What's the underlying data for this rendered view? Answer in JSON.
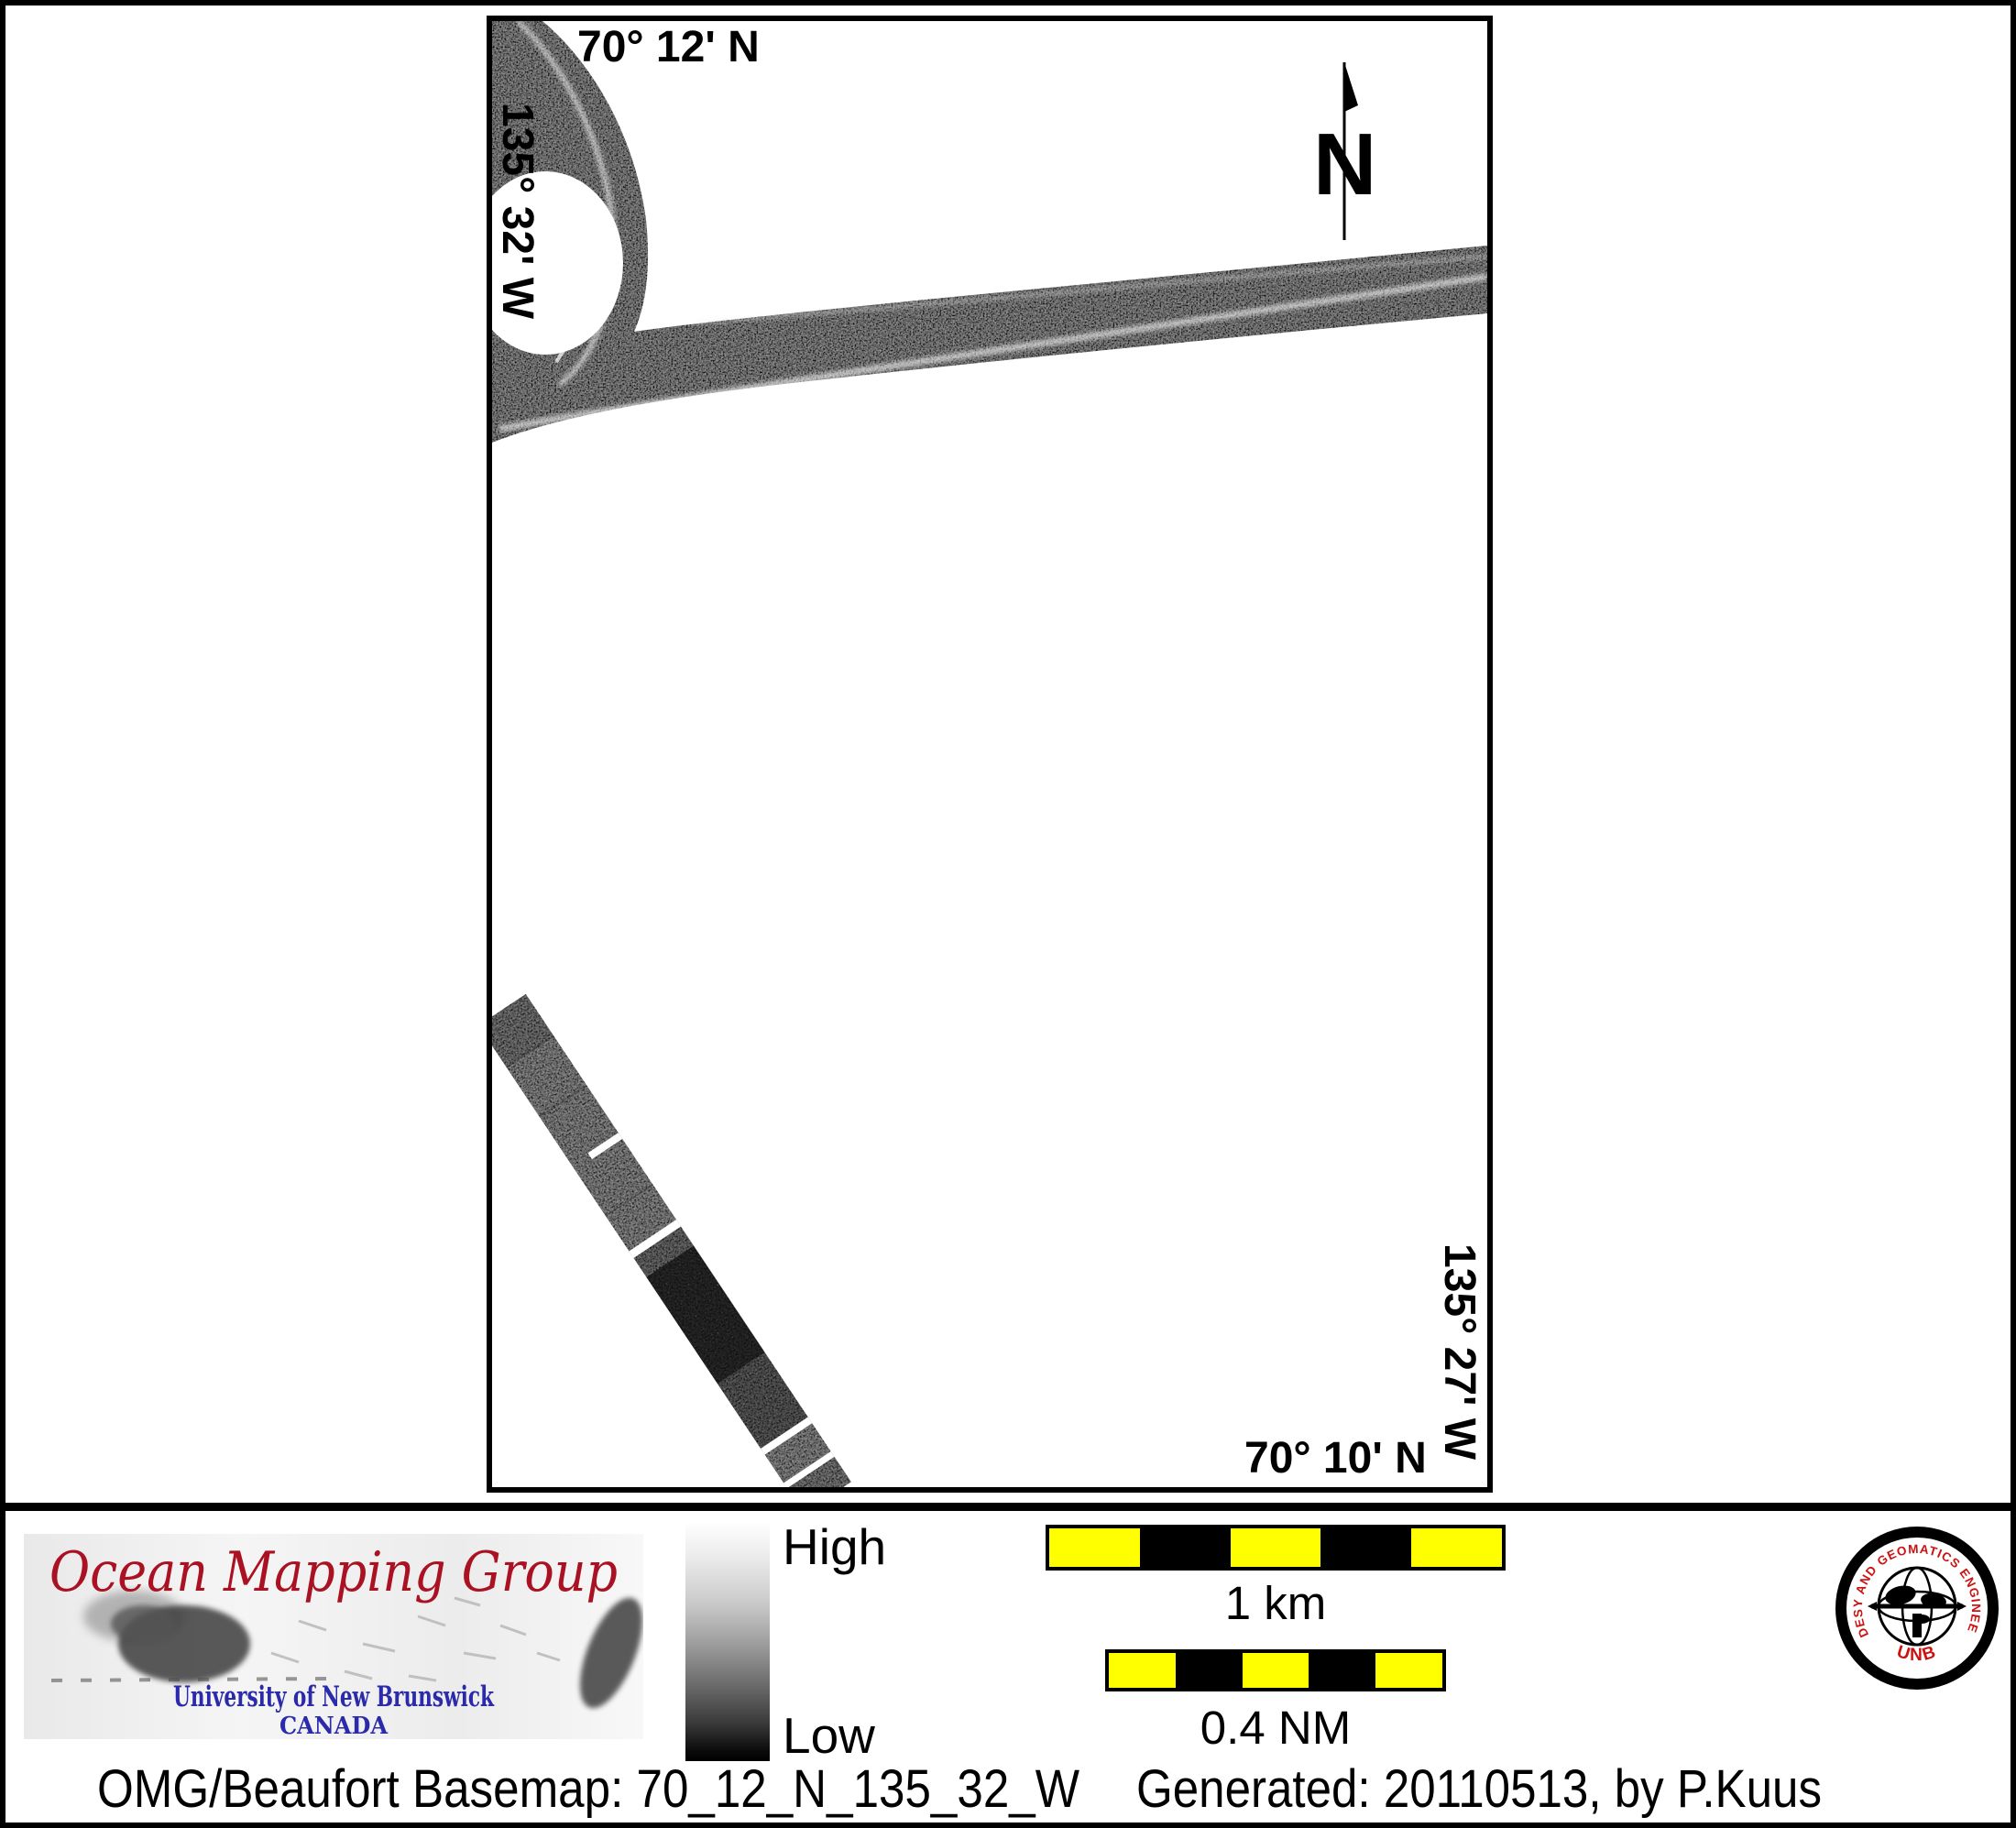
{
  "map": {
    "top_latitude_label": "70° 12' N",
    "left_longitude_label": "135° 32' W",
    "right_longitude_label": "135° 27' W",
    "bottom_latitude_label": "70° 10' N",
    "north_arrow_label": "N"
  },
  "legend": {
    "high_label": "High",
    "low_label": "Low"
  },
  "scale_bars": {
    "km_label": "1 km",
    "nm_label": "0.4 NM"
  },
  "omg_logo": {
    "title": "Ocean Mapping Group",
    "university": "University of New Brunswick",
    "country": "CANADA"
  },
  "unb_seal": {
    "ring_text": "GEODESY AND GEOMATICS ENGINEERING",
    "acronym": "UNB"
  },
  "footer": {
    "basemap_text": "OMG/Beaufort Basemap: 70_12_N_135_32_W",
    "generated_text": "Generated: 20110513, by P.Kuus"
  },
  "colors": {
    "scalebar_yellow": "#ffff00",
    "logo_title_red": "#aa1122",
    "logo_text_blue": "#2a2aaa",
    "seal_red": "#cc1111"
  }
}
